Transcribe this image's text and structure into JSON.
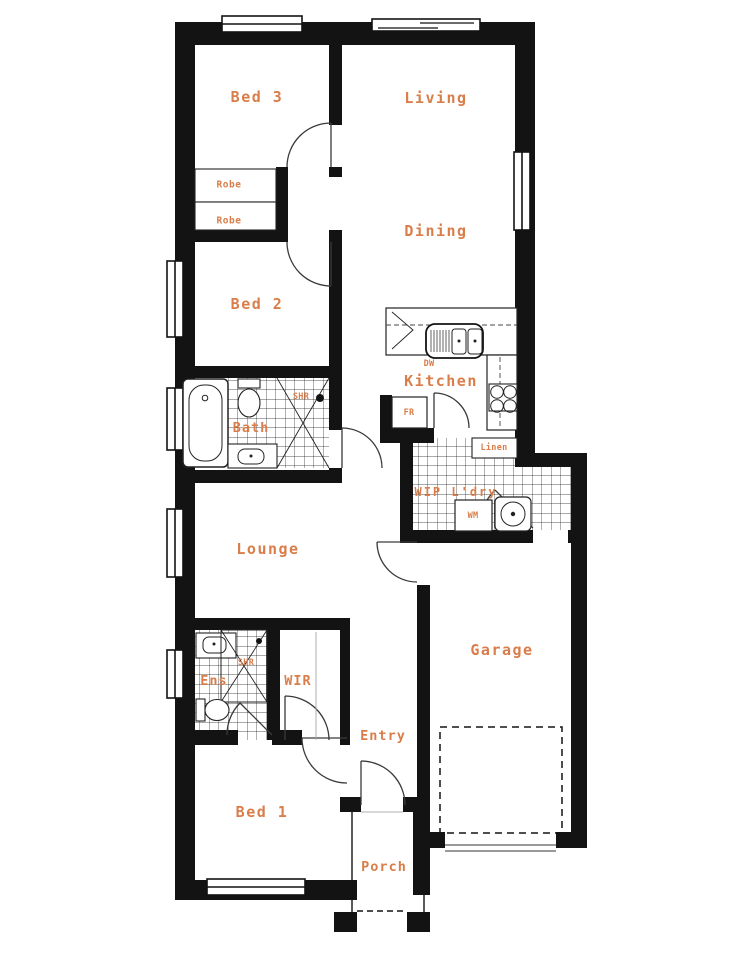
{
  "plan": {
    "type": "house-floor-plan",
    "colors": {
      "label_orange": "#d97e4a",
      "wall_black": "#131313",
      "background": "#ffffff"
    },
    "labels": {
      "bed3": "Bed 3",
      "living": "Living",
      "dining": "Dining",
      "bed2": "Bed 2",
      "kitchen": "Kitchen",
      "bath": "Bath",
      "lounge": "Lounge",
      "garage": "Garage",
      "ens": "Ens",
      "wir": "WIR",
      "entry": "Entry",
      "bed1": "Bed 1",
      "porch": "Porch",
      "robe_top": "Robe",
      "robe_bottom": "Robe",
      "dw": "DW",
      "fr": "FR",
      "shr_bath": "SHR",
      "shr_ens": "SHR",
      "linen": "Linen",
      "wip_ldry": "WIP L'dry",
      "wm": "WM"
    }
  }
}
